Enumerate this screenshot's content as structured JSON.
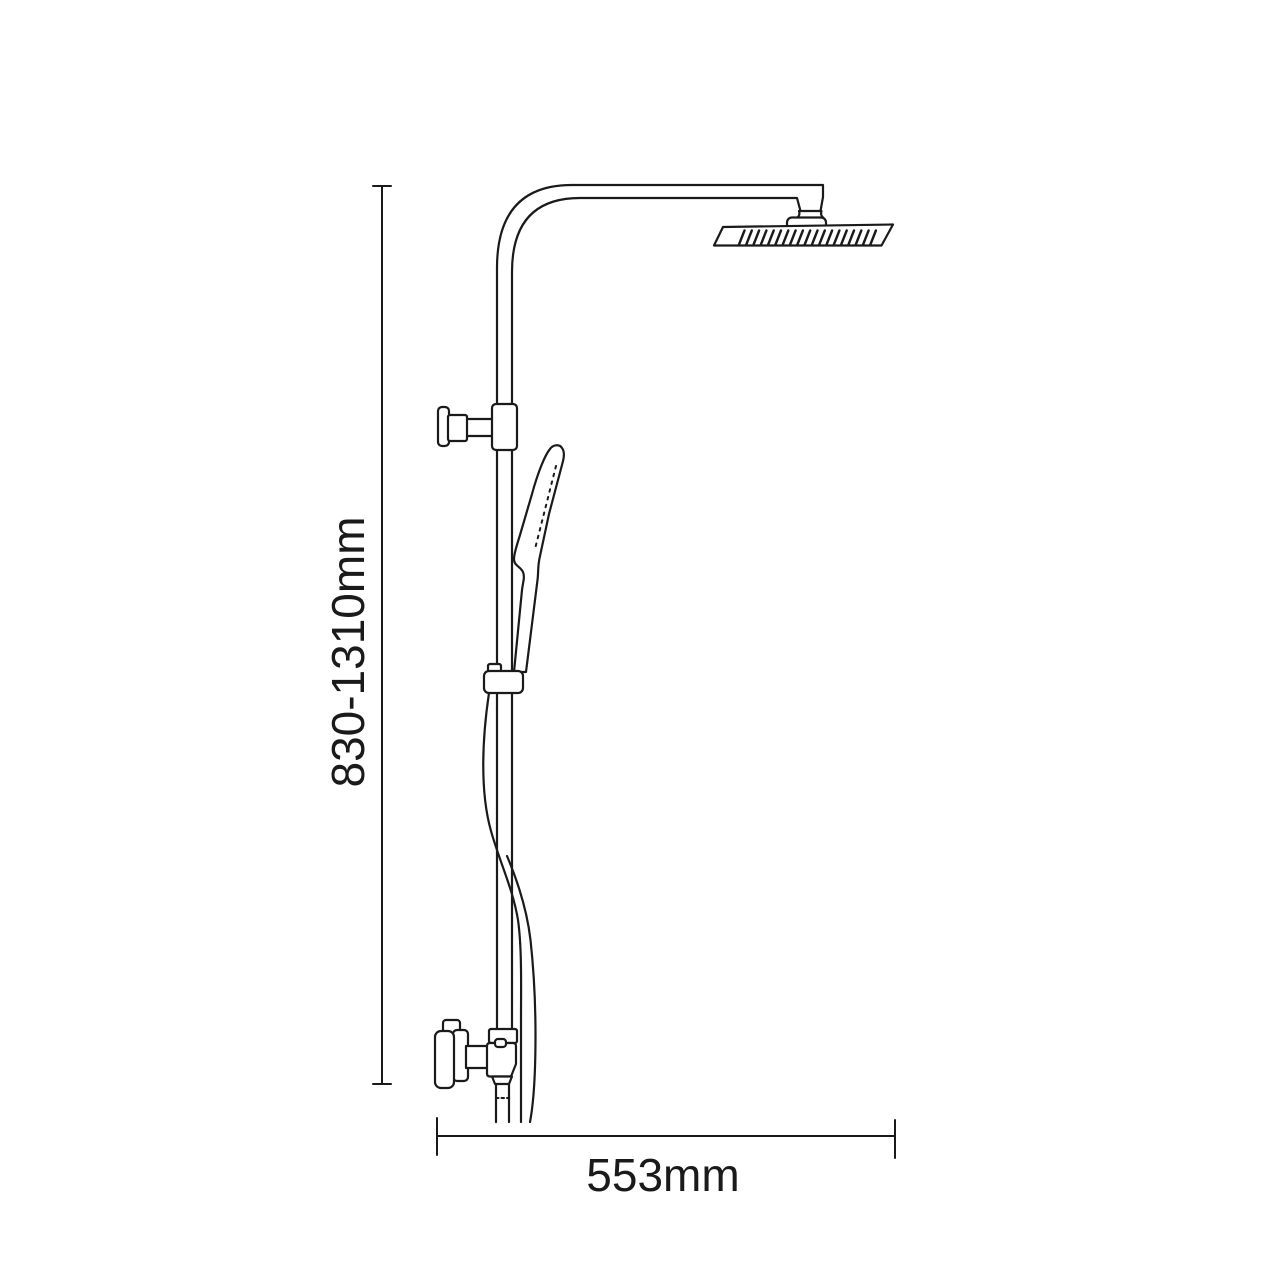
{
  "diagram": {
    "kind": "technical-dimension-drawing",
    "subject": "shower-column-with-overhead-head-and-hand-shower",
    "background_color": "#ffffff",
    "line_color": "#1a1a1a",
    "dimensions": {
      "height_label": "830-1310mm",
      "height_min_mm": 830,
      "height_max_mm": 1310,
      "width_label": "553mm",
      "width_mm": 553
    }
  }
}
